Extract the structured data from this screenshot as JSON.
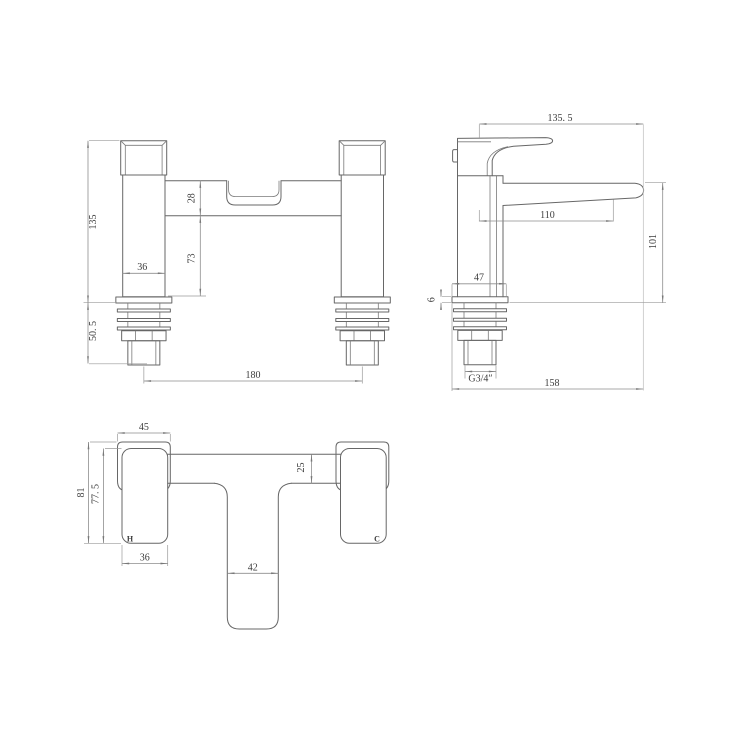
{
  "drawing": {
    "title": "bath-filler-tap-technical-drawing",
    "background": "#ffffff",
    "line_color": "#676767",
    "dim_color": "#8d8d8d",
    "text_color": "#3c3c3c",
    "views": {
      "front": {
        "dims": {
          "overall_height": "135",
          "shank_length": "50. 5",
          "pillar_width": "36",
          "bridge_height": "28",
          "body_height": "73",
          "tap_centres": "180"
        }
      },
      "side": {
        "dims": {
          "overall_reach": "135. 5",
          "spout_reach": "110",
          "spout_height": "101",
          "base_width": "47",
          "plate_thickness": "6",
          "thread_size": "G3/4″",
          "overall_length": "158"
        }
      },
      "plan": {
        "dims": {
          "handle_width": "45",
          "overall_depth": "81",
          "body_depth": "77. 5",
          "bridge_depth": "25",
          "body_width": "36",
          "spout_width": "42"
        },
        "labels": {
          "hot": "H",
          "cold": "C"
        }
      }
    }
  }
}
